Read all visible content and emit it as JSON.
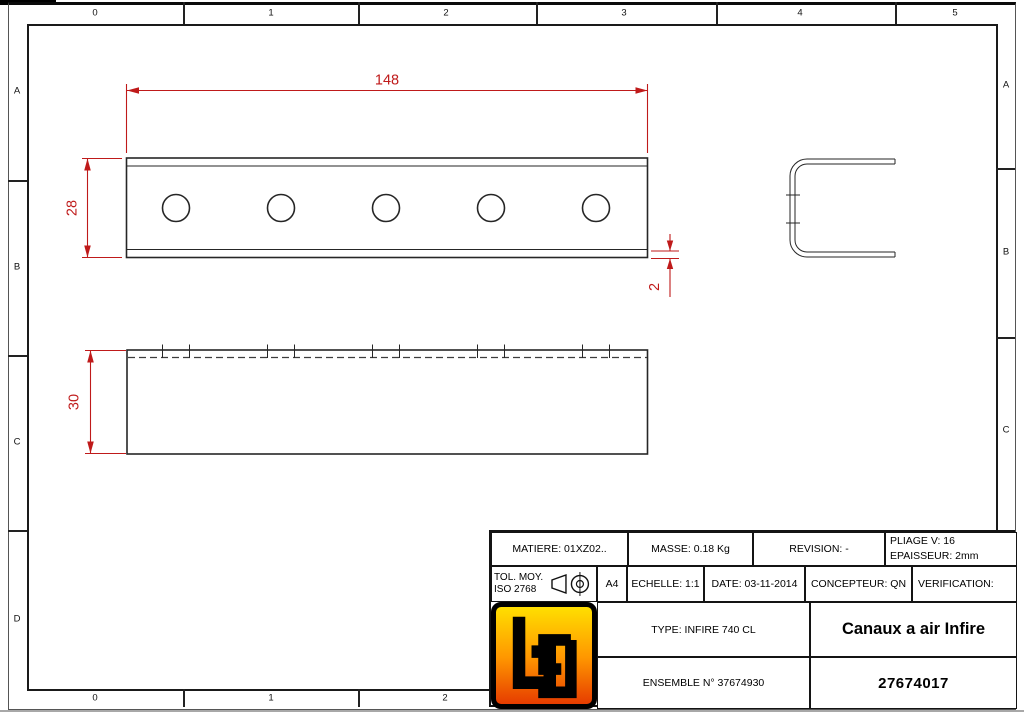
{
  "frame": {
    "top_labels": [
      "0",
      "1",
      "2",
      "3",
      "4",
      "5"
    ],
    "bottom_labels": [
      "0",
      "1",
      "2"
    ],
    "left_labels": [
      "A",
      "B",
      "C",
      "D"
    ],
    "right_labels": [
      "A",
      "B",
      "C"
    ]
  },
  "drawing": {
    "dim_color": "#bf1a1a",
    "line_color": "#262626",
    "dimensions": {
      "length": "148",
      "height": "28",
      "thickness": "2",
      "depth": "30"
    }
  },
  "title_block": {
    "matiere": "MATIERE: 01XZ02..",
    "masse": "MASSE: 0.18 Kg",
    "revision": "REVISION: -",
    "pliage": "PLIAGE V: 16",
    "epaisseur": "EPAISSEUR: 2mm",
    "tol_line1": "TOL. MOY.",
    "tol_line2": "ISO 2768",
    "format": "A4",
    "echelle": "ECHELLE: 1:1",
    "date": "DATE: 03-11-2014",
    "concepteur": "CONCEPTEUR: QN",
    "verification": "VERIFICATION:",
    "type": "TYPE: INFIRE 740 CL",
    "ensemble": "ENSEMBLE N° 37674930",
    "title": "Canaux a air Infire",
    "number": "27674017"
  }
}
